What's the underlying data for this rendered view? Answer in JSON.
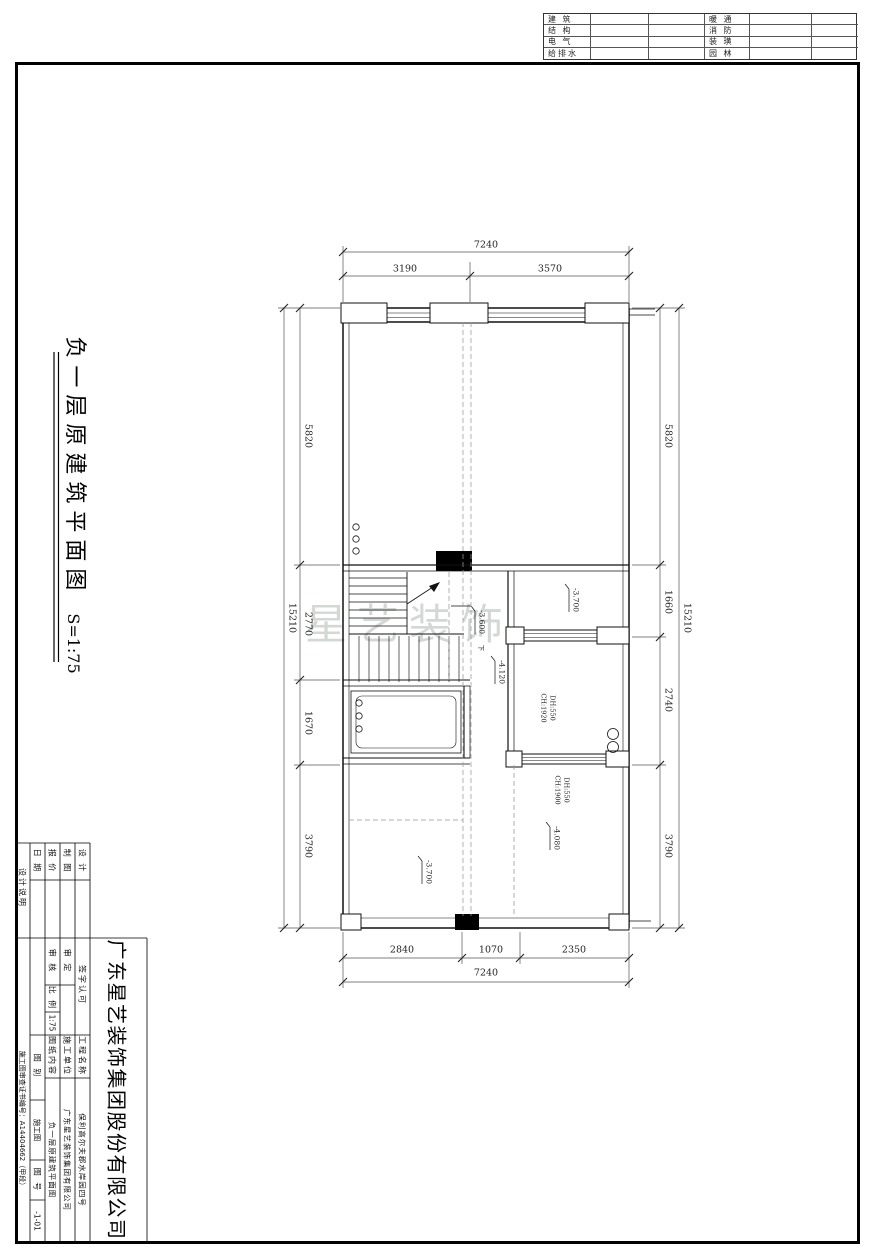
{
  "consultants": {
    "rows": [
      {
        "left": "建 筑",
        "right": "暖 通"
      },
      {
        "left": "结 构",
        "right": "消 防"
      },
      {
        "left": "电 气",
        "right": "装 璜"
      },
      {
        "left": "给排水",
        "right": "园 林"
      }
    ]
  },
  "title": {
    "text": "负一层原建筑平面图",
    "scale": "S=1:75"
  },
  "watermark": "星艺装饰",
  "plan": {
    "dims": {
      "top_overall": "7240",
      "top_seg_a": "3190",
      "top_seg_b": "3570",
      "bottom_seg_a": "2840",
      "bottom_seg_b": "1070",
      "bottom_seg_c": "2350",
      "bottom_overall": "7240",
      "left_seg_a": "5820",
      "left_seg_b": "2770",
      "left_seg_c": "1670",
      "left_seg_d": "3790",
      "left_overall": "15210",
      "right_seg_a": "5820",
      "right_seg_b": "1660",
      "right_seg_c": "2740",
      "right_seg_d": "3790",
      "right_overall": "15210"
    },
    "elev_mid_right": "-3.700",
    "elev_stair": "-3.600",
    "elev_corridor": "-4.120",
    "elev_lower_left": "-3.700",
    "elev_lower_right": "-4.080",
    "door_top_l1": "DH:550",
    "door_top_l2": "CH:1920",
    "door_bottom_l1": "DH:550",
    "door_bottom_l2": "CH:1900",
    "stair_down": "下"
  },
  "title_block": {
    "company": "广东星艺装饰集团股份有限公司",
    "design": "设 计",
    "draft": "制 图",
    "quote": "报 价",
    "date": "日 期",
    "side_note": "设计说明",
    "sign": "签字认可",
    "approve": "审 定",
    "check": "审 核",
    "scale_label": "比 例",
    "scale_value": "1:75",
    "project_label": "工程名称",
    "project_value": "保利高尔夫郡水岸园四号",
    "builder_label": "施工单位",
    "builder_value": "广东星艺装饰集团有限公司",
    "content_label": "图纸内容",
    "content_value": "负一层原建筑平面图",
    "type_label": "图 别",
    "type_value": "施工图",
    "no_label": "图 号",
    "no_value": "-1-01",
    "cert_note": "施工图审查证书编号：A14404662（甲段）"
  }
}
